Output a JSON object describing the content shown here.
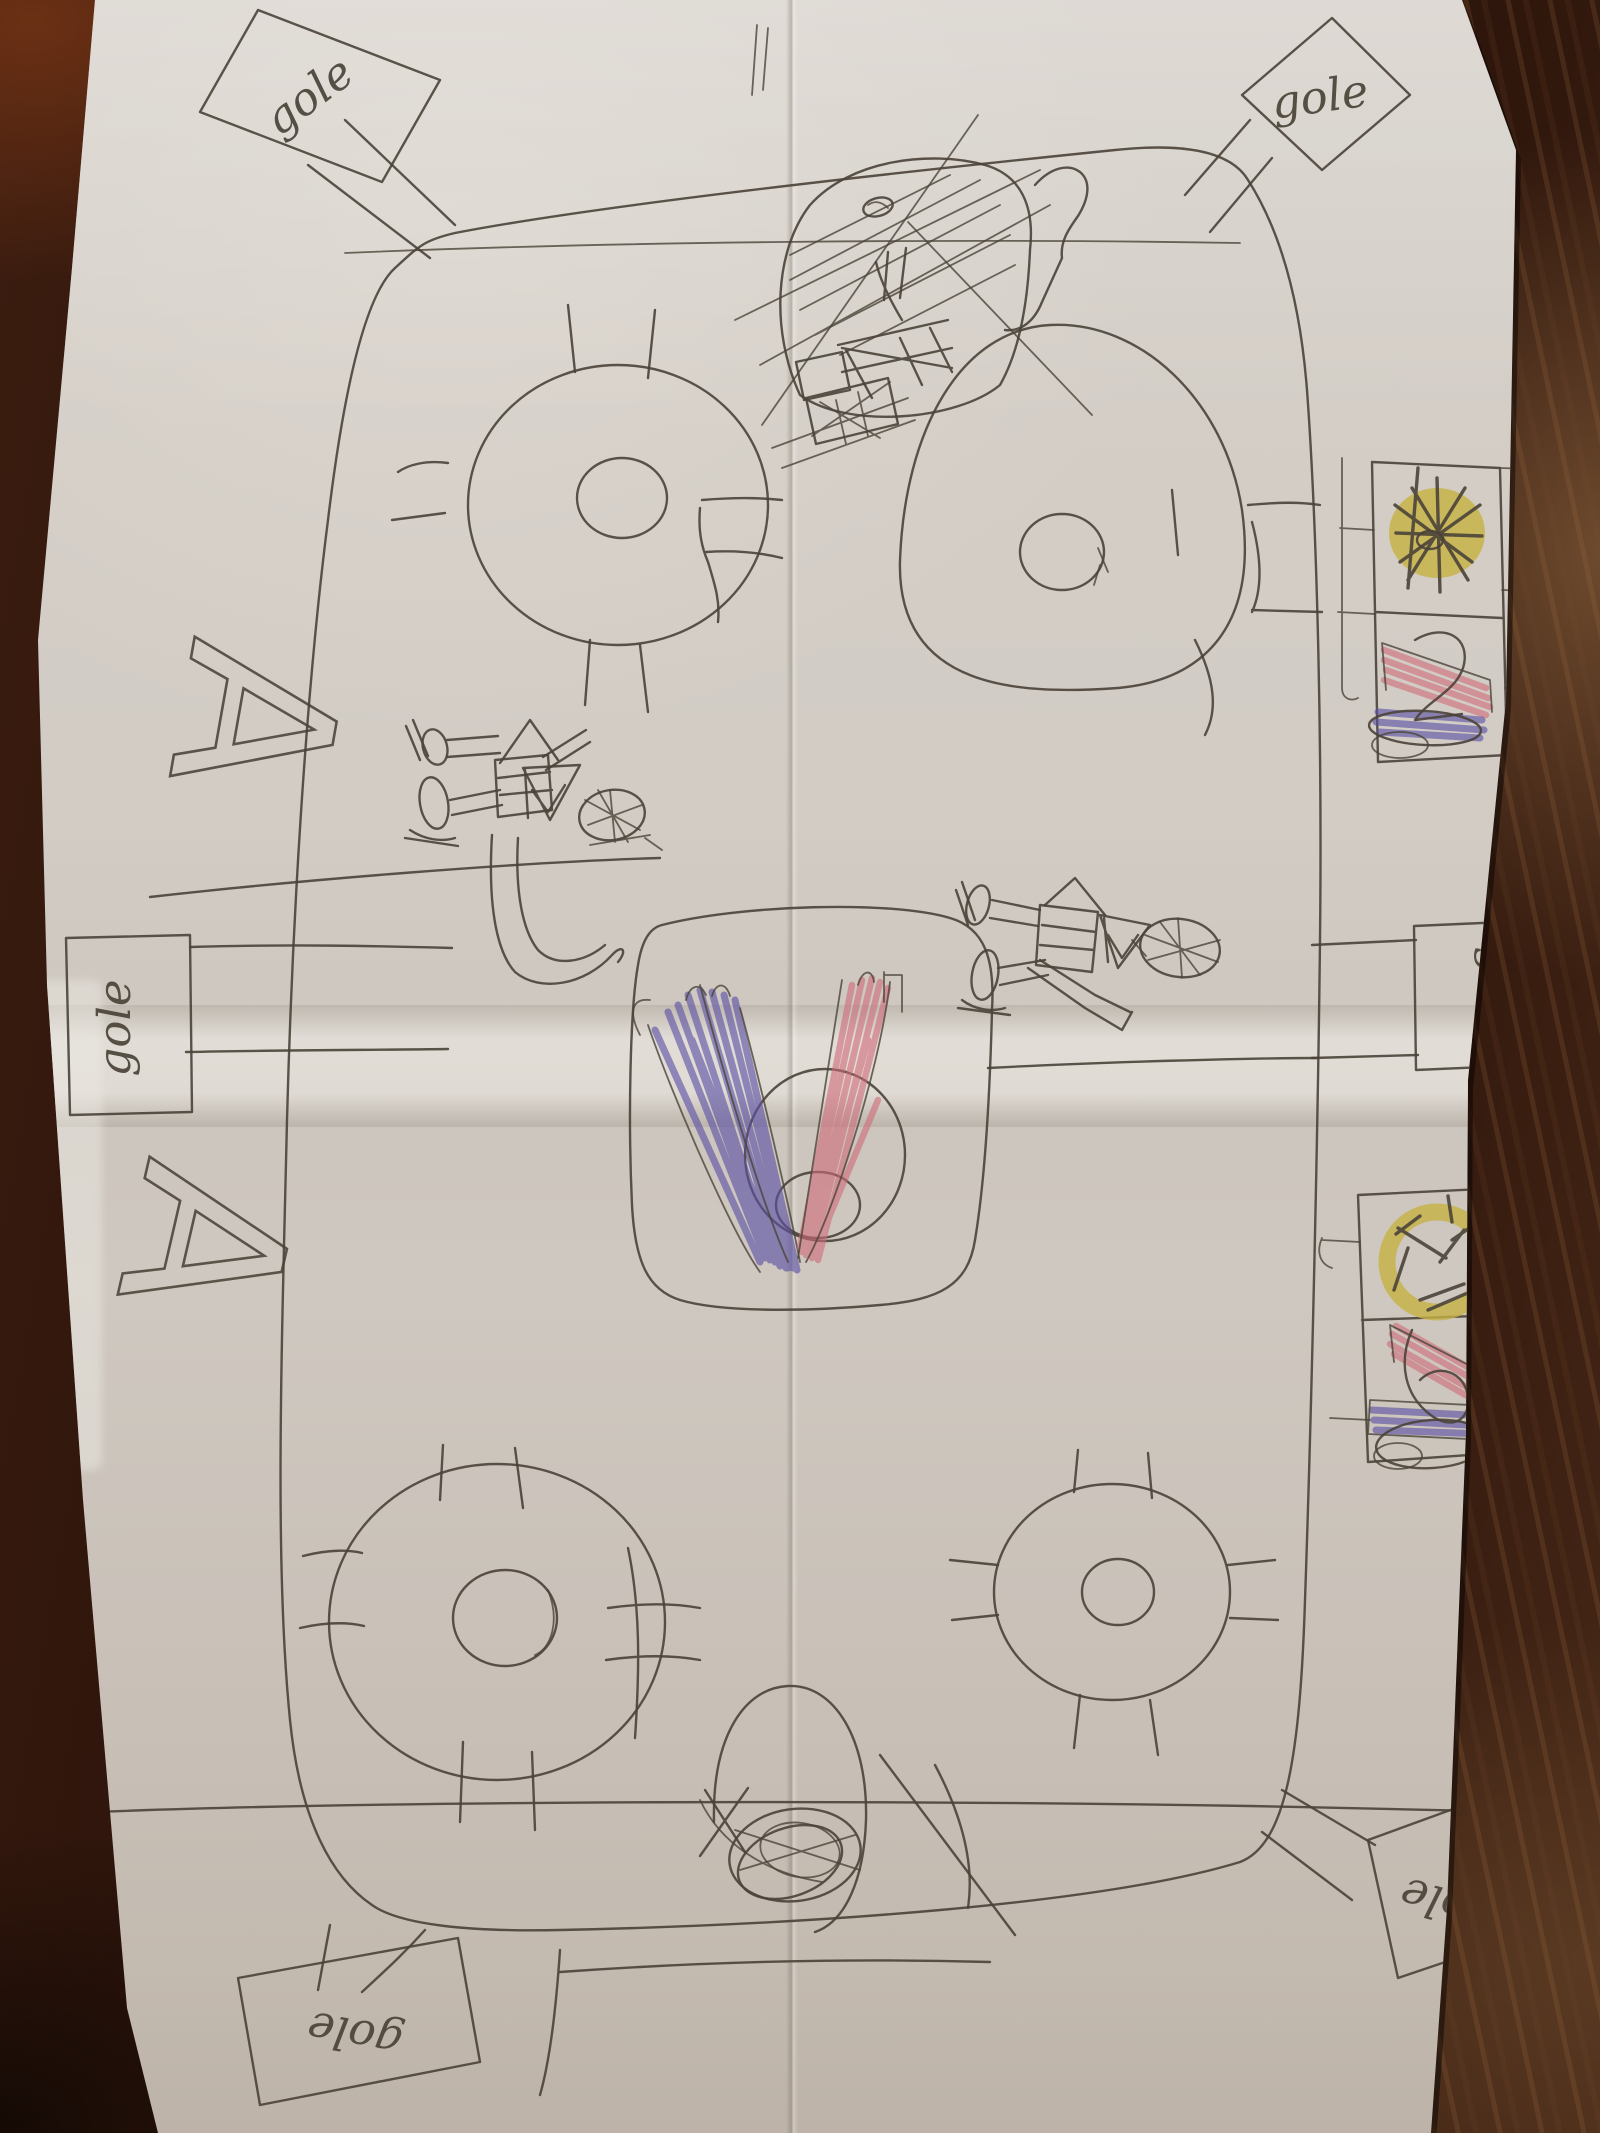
{
  "palette": {
    "wood_dark": "#200e07",
    "wood_mid": "#3c1d10",
    "wood_light": "#7a5638",
    "paper": "#d3ccc4",
    "ink": "#4a4338",
    "scribble_yellow": "#c6b243",
    "scribble_red": "#cf6a78",
    "scribble_blue": "#5b51a5"
  },
  "drawing": {
    "goal_flags": [
      {
        "position": "top-left",
        "label": "gole"
      },
      {
        "position": "top-right",
        "label": "gole"
      },
      {
        "position": "middle-left",
        "label": "gole"
      },
      {
        "position": "middle-right",
        "label": "gole"
      },
      {
        "position": "bottom-right",
        "label": "gole"
      },
      {
        "position": "bottom-left",
        "label": "gole"
      }
    ],
    "side_letters": [
      {
        "position": "upper-left",
        "label": "A"
      },
      {
        "position": "lower-left",
        "label": "A"
      }
    ]
  }
}
